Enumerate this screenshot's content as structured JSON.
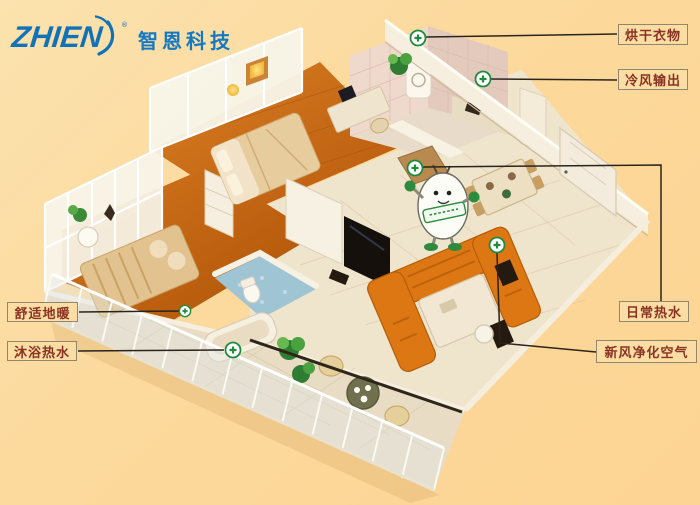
{
  "logo": {
    "brand": "ZHIEN",
    "registered": "®",
    "company": "智恩科技"
  },
  "callouts": {
    "drying": "烘干衣物",
    "cold_air": "冷风输出",
    "daily_hot_water": "日常热水",
    "fresh_air": "新风净化空气",
    "floor_heating": "舒适地暖",
    "bath_hot_water": "沐浴热水"
  },
  "colors": {
    "background": "#fcd99c",
    "label_text": "#8a3322",
    "label_border": "#94866c",
    "marker_green": "#1e8c3c",
    "logo_blue": "#1272b8",
    "wood_floor": "#c96a16",
    "tile_floor": "#efe4cc",
    "bath_floor_blue": "#9fc4d4",
    "sofa_orange": "#dd7714"
  }
}
